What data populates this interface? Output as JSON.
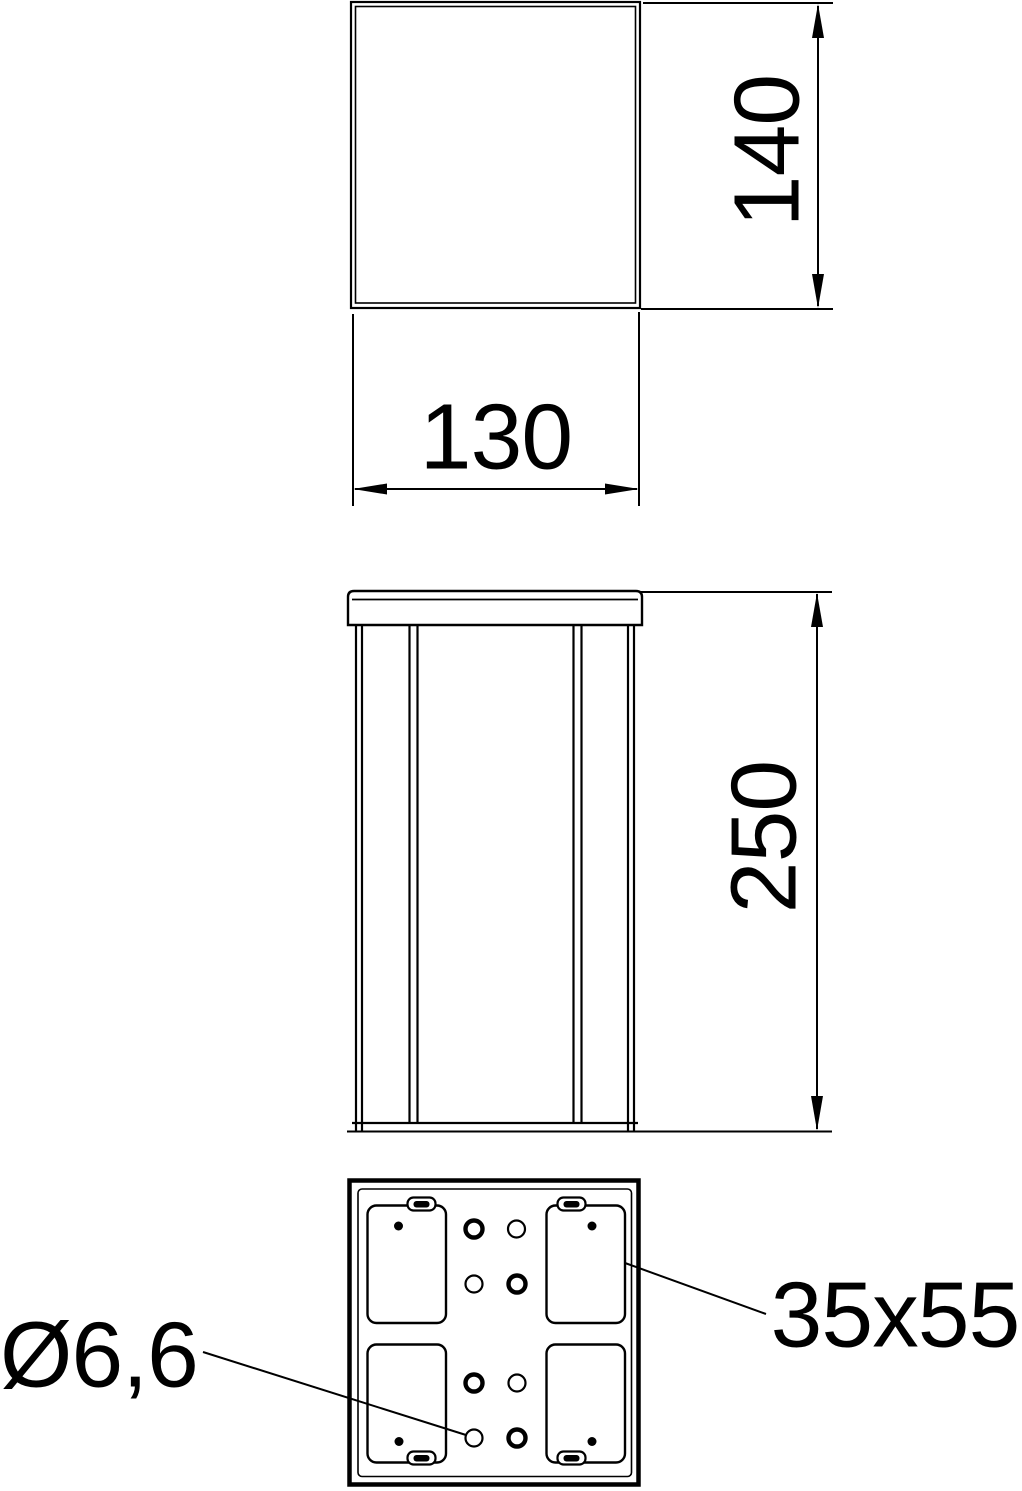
{
  "drawing": {
    "background_color": "#ffffff",
    "line_color": "#000000",
    "labels": {
      "top_view_width": "130",
      "top_view_depth": "140",
      "front_view_height": "250",
      "hole_diameter": "Ø6,6",
      "cutout_size": "35x55"
    }
  }
}
